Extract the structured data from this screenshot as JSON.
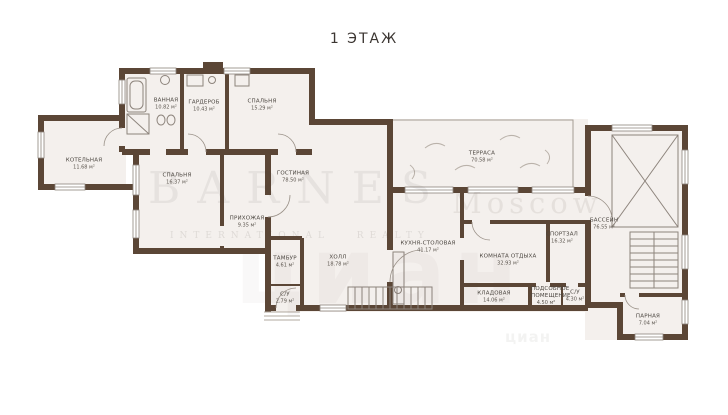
{
  "title": "1 ЭТАЖ",
  "watermark": {
    "brand": "BARNES",
    "subtitle": "INTERNATIONAL REALTY",
    "city": "Moscow",
    "cian": "циан"
  },
  "colors": {
    "wall": "#5b4636",
    "floor": "#f4f0ed",
    "thin_line": "#8d847c",
    "label_text": "#4a453f"
  },
  "rooms": [
    {
      "name": "ВАННАЯ",
      "area": "10.82 м²"
    },
    {
      "name": "ГАРДЕРОБ",
      "area": "10.43 м²"
    },
    {
      "name": "СПАЛЬНЯ",
      "area": "15.29 м²"
    },
    {
      "name": "КОТЕЛЬНАЯ",
      "area": "11.68 м²"
    },
    {
      "name": "СПАЛЬНЯ",
      "area": "16.37 м²"
    },
    {
      "name": "ГОСТИНАЯ",
      "area": "78.50 м²"
    },
    {
      "name": "ТЕРРАСА",
      "area": "70.58 м²"
    },
    {
      "name": "ПРИХОЖАЯ",
      "area": "9.35 м²"
    },
    {
      "name": "ТАМБУР",
      "area": "4.61 м²"
    },
    {
      "name": "ХОЛЛ",
      "area": "18.78 м²"
    },
    {
      "name": "С/У",
      "area": "2.79 м²"
    },
    {
      "name": "КУХНЯ-СТОЛОВАЯ",
      "area": "41.17 м²"
    },
    {
      "name": "КОМНАТА ОТДЫХА",
      "area": "32.93 м²"
    },
    {
      "name": "СПОРТЗАЛ",
      "area": "16.32 м²"
    },
    {
      "name": "БАССЕЙН",
      "area": "76.55 м²"
    },
    {
      "name": "КЛАДОВАЯ",
      "area": "14.06 м²"
    },
    {
      "name": "ПОДСОБНОЕ ПОМЕЩЕНИЕ",
      "area": "4.50 м²"
    },
    {
      "name": "С/У",
      "area": "4.30 м²"
    },
    {
      "name": "ПАРНАЯ",
      "area": "7.04 м²"
    }
  ]
}
